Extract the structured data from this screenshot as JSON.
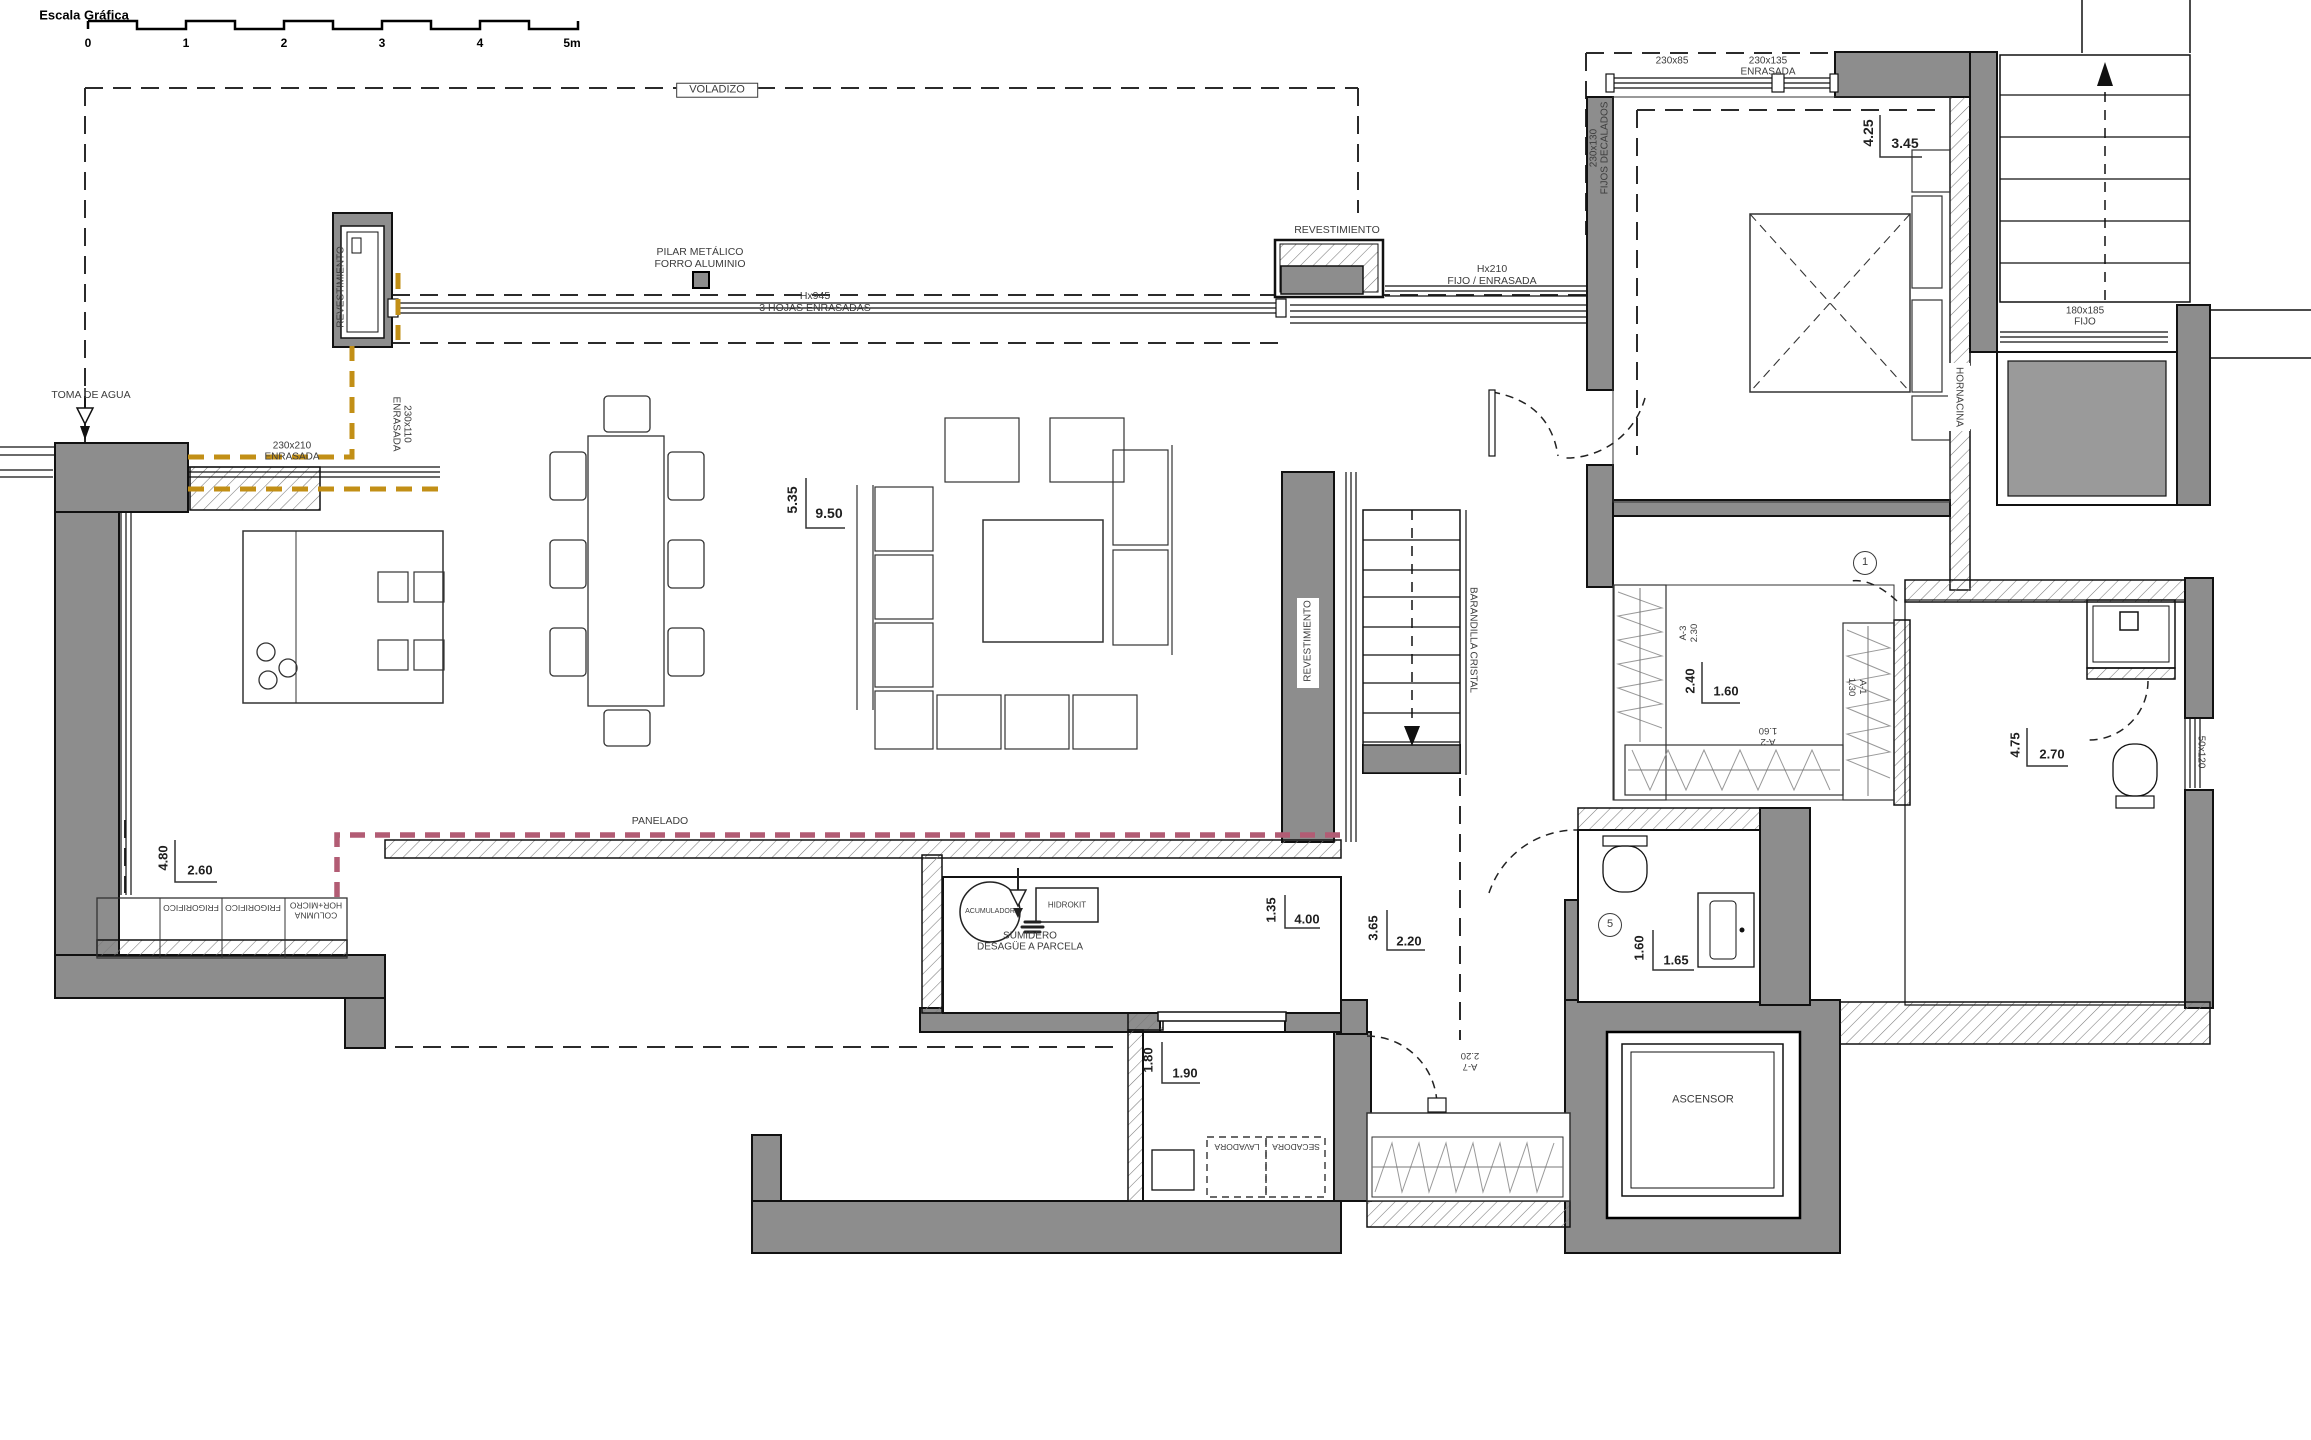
{
  "meta": {
    "drawing_type": "architectural floor plan"
  },
  "colors": {
    "background": "#ffffff",
    "wall_gray": "#8d8d8d",
    "line": "#1a1a1a",
    "carpentry_dashed_yellow": "#c28f16",
    "panel_dashed_pink": "#b25c74"
  },
  "annotations": [
    {
      "id": "scale-bar-title",
      "text": "Escala Gráfica",
      "x": 84,
      "y": 16,
      "fs": 13,
      "cls": "bold"
    },
    {
      "id": "scale-tick-0",
      "text": "0",
      "x": 88,
      "y": 44,
      "fs": 12,
      "cls": "bold"
    },
    {
      "id": "scale-tick-1",
      "text": "1",
      "x": 186,
      "y": 44,
      "fs": 12,
      "cls": "bold"
    },
    {
      "id": "scale-tick-2",
      "text": "2",
      "x": 284,
      "y": 44,
      "fs": 12,
      "cls": "bold"
    },
    {
      "id": "scale-tick-3",
      "text": "3",
      "x": 382,
      "y": 44,
      "fs": 12,
      "cls": "bold"
    },
    {
      "id": "scale-tick-4",
      "text": "4",
      "x": 480,
      "y": 44,
      "fs": 12,
      "cls": "bold"
    },
    {
      "id": "scale-tick-5m",
      "text": "5m",
      "x": 572,
      "y": 44,
      "fs": 12,
      "cls": "bold"
    },
    {
      "id": "voladizo-label",
      "text": "VOLADIZO",
      "x": 717,
      "y": 90,
      "fs": 11,
      "cls": "box"
    },
    {
      "id": "pilar-metalico-label",
      "text": "PILAR METÁLICO\nFORRO ALUMINIO",
      "x": 700,
      "y": 259,
      "fs": 10.5
    },
    {
      "id": "revestimiento-pillar-label",
      "text": "REVESTIMIENTO",
      "x": 341,
      "y": 287,
      "rot": -90,
      "fs": 10
    },
    {
      "id": "toma-de-agua-label",
      "text": "TOMA DE AGUA",
      "x": 91,
      "y": 396,
      "fs": 10.5
    },
    {
      "id": "window-230x210-label",
      "text": "230x210\nENRASADA",
      "x": 292,
      "y": 452,
      "fs": 10
    },
    {
      "id": "window-230x110-label",
      "text": "230x110\nENRASADA",
      "x": 401,
      "y": 424,
      "rot": 90,
      "fs": 10
    },
    {
      "id": "hojas-enrasadas-label",
      "text": "Hx945\n3 HOJAS ENRASADAS",
      "x": 815,
      "y": 303,
      "fs": 10.5
    },
    {
      "id": "revestimiento-top-label",
      "text": "REVESTIMIENTO",
      "x": 1337,
      "y": 231,
      "fs": 10.5
    },
    {
      "id": "fijo-enrasada-hx210-label",
      "text": "Hx210\nFIJO / ENRASADA",
      "x": 1492,
      "y": 276,
      "fs": 10.5
    },
    {
      "id": "window-230x85-label",
      "text": "230x85",
      "x": 1672,
      "y": 61,
      "fs": 10
    },
    {
      "id": "window-230x135-label",
      "text": "230x135\nENRASADA",
      "x": 1768,
      "y": 67,
      "fs": 10
    },
    {
      "id": "fijos-decalados-label",
      "text": "230x130\nFIJOS DECALADOS",
      "x": 1600,
      "y": 148,
      "rot": -90,
      "fs": 10
    },
    {
      "id": "dim-4-25",
      "text": "4.25",
      "x": 1869,
      "y": 133,
      "rot": -90,
      "fs": 14,
      "cls": "dim"
    },
    {
      "id": "dim-3-45",
      "text": "3.45",
      "x": 1905,
      "y": 144,
      "fs": 14,
      "cls": "dim"
    },
    {
      "id": "window-180x185-label",
      "text": "180x185\nFIJO",
      "x": 2085,
      "y": 317,
      "fs": 10
    },
    {
      "id": "hornacina-label",
      "text": "HORNACINA",
      "x": 1959,
      "y": 397,
      "rot": 90,
      "fs": 10
    },
    {
      "id": "dim-5-35",
      "text": "5.35",
      "x": 793,
      "y": 500,
      "rot": -90,
      "fs": 14,
      "cls": "dim"
    },
    {
      "id": "dim-9-50",
      "text": "9.50",
      "x": 829,
      "y": 514,
      "fs": 14,
      "cls": "dim"
    },
    {
      "id": "revestimiento-right-label",
      "text": "REVESTIMIENTO",
      "x": 1308,
      "y": 641,
      "rot": -90,
      "fs": 10
    },
    {
      "id": "barandilla-cristal-label",
      "text": "BARANDILLA CRISTAL",
      "x": 1473,
      "y": 640,
      "rot": 90,
      "fs": 10
    },
    {
      "id": "closet-a3-label",
      "text": "A-3\n2.30",
      "x": 1690,
      "y": 633,
      "rot": -90,
      "fs": 9.5
    },
    {
      "id": "dim-2-40",
      "text": "2.40",
      "x": 1691,
      "y": 681,
      "rot": -90,
      "fs": 13,
      "cls": "dim"
    },
    {
      "id": "dim-1-60-closet",
      "text": "1.60",
      "x": 1726,
      "y": 692,
      "fs": 13,
      "cls": "dim"
    },
    {
      "id": "closet-a1-label",
      "text": "A-1\n1.30",
      "x": 1856,
      "y": 687,
      "rot": 90,
      "fs": 9.5
    },
    {
      "id": "closet-a2-label",
      "text": "A-2\n1.60",
      "x": 1768,
      "y": 735,
      "rot": 180,
      "fs": 9.5
    },
    {
      "id": "dim-4-75",
      "text": "4.75",
      "x": 2016,
      "y": 745,
      "rot": -90,
      "fs": 13,
      "cls": "dim"
    },
    {
      "id": "dim-2-70",
      "text": "2.70",
      "x": 2052,
      "y": 755,
      "fs": 13,
      "cls": "dim"
    },
    {
      "id": "window-50x120-label",
      "text": "50x120",
      "x": 2201,
      "y": 752,
      "rot": 90,
      "fs": 10
    },
    {
      "id": "circle-ref-1",
      "text": "1",
      "x": 1865,
      "y": 563,
      "fs": 11,
      "cls": "circ"
    },
    {
      "id": "circle-ref-5",
      "text": "5",
      "x": 1610,
      "y": 925,
      "fs": 11,
      "cls": "circ"
    },
    {
      "id": "dim-4-80",
      "text": "4.80",
      "x": 164,
      "y": 858,
      "rot": -90,
      "fs": 13,
      "cls": "dim"
    },
    {
      "id": "dim-2-60",
      "text": "2.60",
      "x": 200,
      "y": 871,
      "fs": 13,
      "cls": "dim"
    },
    {
      "id": "columna-hor-micro-label",
      "text": "COLUMNA\nHOR+MICRO",
      "x": 316,
      "y": 910,
      "rot": 180,
      "fs": 8.5
    },
    {
      "id": "frigorifico-1-label",
      "text": "FRIGORIFICO",
      "x": 253,
      "y": 907,
      "rot": 180,
      "fs": 8.5
    },
    {
      "id": "frigorifico-2-label",
      "text": "FRIGORIFICO",
      "x": 191,
      "y": 907,
      "rot": 180,
      "fs": 8.5
    },
    {
      "id": "panelado-label",
      "text": "PANELADO",
      "x": 660,
      "y": 822,
      "fs": 10.5
    },
    {
      "id": "acumulador-label",
      "text": "ACUMULADOR",
      "x": 990,
      "y": 912,
      "fs": 7
    },
    {
      "id": "hidrokit-label",
      "text": "HIDROKIT",
      "x": 1067,
      "y": 905,
      "fs": 8
    },
    {
      "id": "sumidero-label",
      "text": "SUMIDERO\nDESAGÜE A PARCELA",
      "x": 1030,
      "y": 942,
      "fs": 10
    },
    {
      "id": "dim-1-35",
      "text": "1.35",
      "x": 1272,
      "y": 910,
      "rot": -90,
      "fs": 13,
      "cls": "dim"
    },
    {
      "id": "dim-4-00",
      "text": "4.00",
      "x": 1307,
      "y": 920,
      "fs": 13,
      "cls": "dim"
    },
    {
      "id": "dim-3-65",
      "text": "3.65",
      "x": 1374,
      "y": 928,
      "rot": -90,
      "fs": 13,
      "cls": "dim"
    },
    {
      "id": "dim-2-20",
      "text": "2.20",
      "x": 1409,
      "y": 942,
      "fs": 13,
      "cls": "dim"
    },
    {
      "id": "dim-1-80",
      "text": "1.80",
      "x": 1149,
      "y": 1060,
      "rot": -90,
      "fs": 13,
      "cls": "dim"
    },
    {
      "id": "dim-1-90",
      "text": "1.90",
      "x": 1185,
      "y": 1074,
      "fs": 13,
      "cls": "dim"
    },
    {
      "id": "lavadora-label",
      "text": "LAVADORA",
      "x": 1237,
      "y": 1146,
      "rot": 180,
      "fs": 8.5
    },
    {
      "id": "secadora-label",
      "text": "SECADORA",
      "x": 1296,
      "y": 1146,
      "rot": 180,
      "fs": 8.5
    },
    {
      "id": "closet-a7-label",
      "text": "A-7\n2.20",
      "x": 1470,
      "y": 1060,
      "rot": 180,
      "fs": 9.5
    },
    {
      "id": "ascensor-label",
      "text": "ASCENSOR",
      "x": 1703,
      "y": 1100,
      "fs": 11
    },
    {
      "id": "dim-1-60-aseo",
      "text": "1.60",
      "x": 1640,
      "y": 948,
      "rot": -90,
      "fs": 13,
      "cls": "dim"
    },
    {
      "id": "dim-1-65",
      "text": "1.65",
      "x": 1676,
      "y": 961,
      "fs": 13,
      "cls": "dim"
    }
  ]
}
